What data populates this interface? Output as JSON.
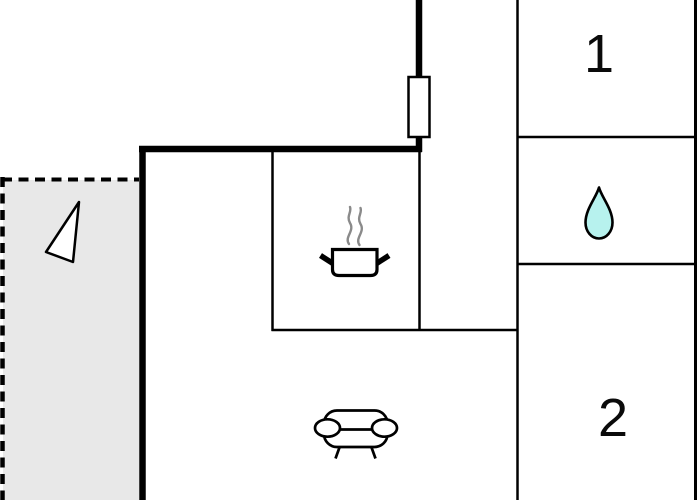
{
  "floorplan": {
    "room1_label": "1",
    "room2_label": "2",
    "colors": {
      "wall": "#000000",
      "terrace_fill": "#e8e8e8",
      "droplet_fill": "#b7f2ee",
      "steam_gray": "#8a8a8a",
      "background": "#ffffff"
    },
    "icons": {
      "window": "window-icon",
      "stove": "stove-pot-icon",
      "droplet": "droplet-icon",
      "sofa": "sofa-icon",
      "terrace_marker": "triangle-marker-icon"
    }
  }
}
